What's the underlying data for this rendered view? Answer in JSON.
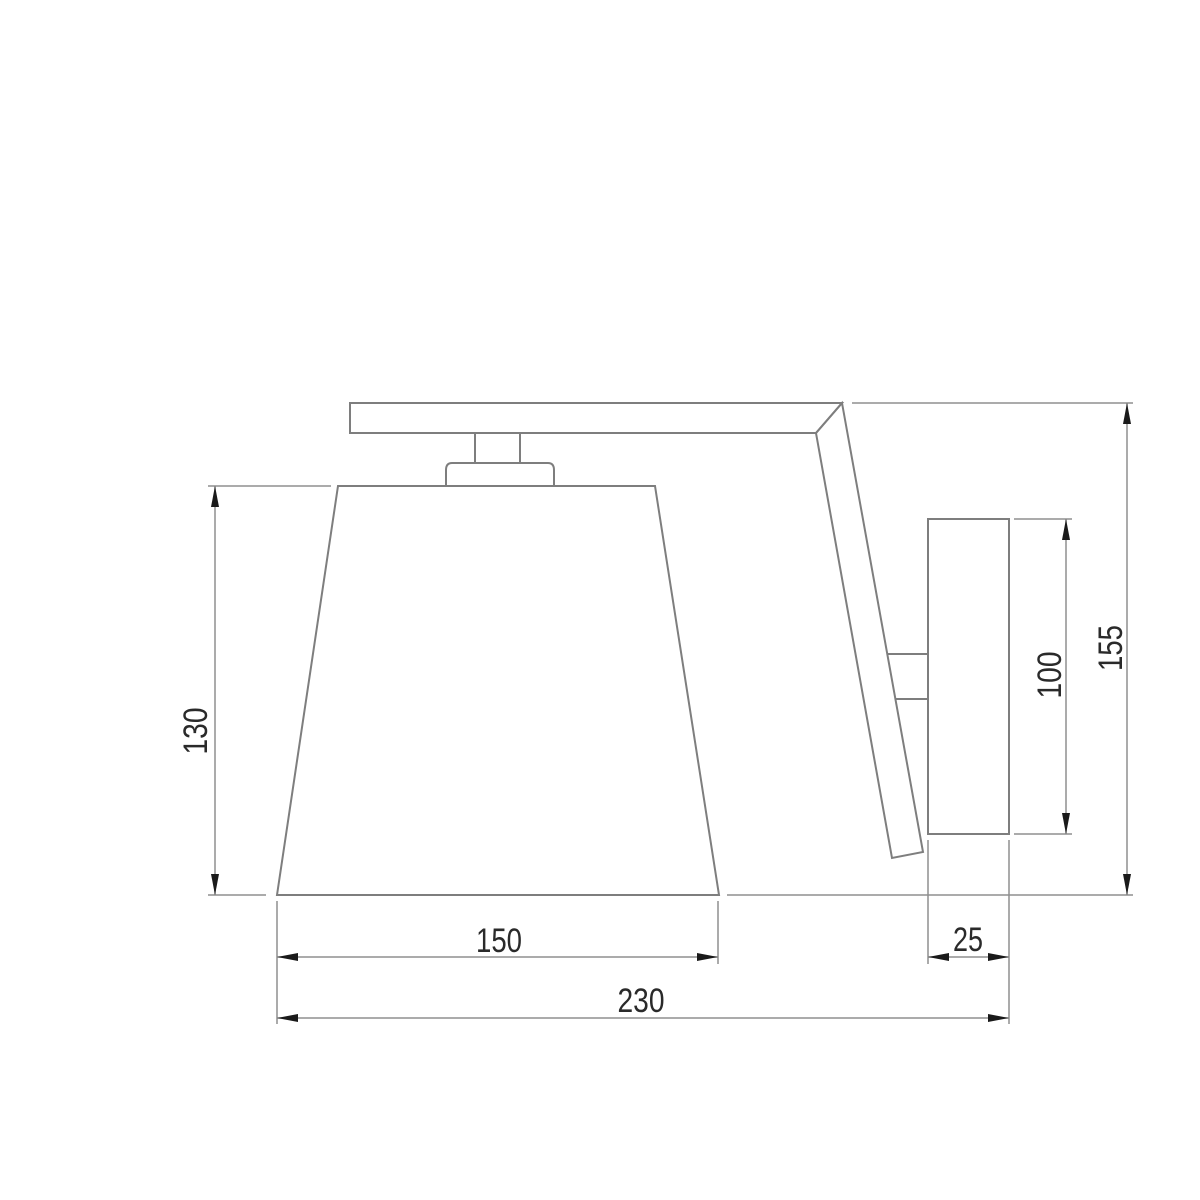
{
  "drawing": {
    "title": "Wall sconce dimensional drawing, side view",
    "units": "mm",
    "dimensions": {
      "shade_height": "130",
      "shade_bottom_width": "150",
      "overall_width": "230",
      "wall_plate_depth": "25",
      "wall_plate_height": "100",
      "overall_height": "155"
    },
    "colors": {
      "background": "#ffffff",
      "outline": "#7e7e7e",
      "dimension_lines": "#8f8f8f",
      "arrows": "#1a1a1a",
      "text": "#2a2a2a"
    }
  }
}
